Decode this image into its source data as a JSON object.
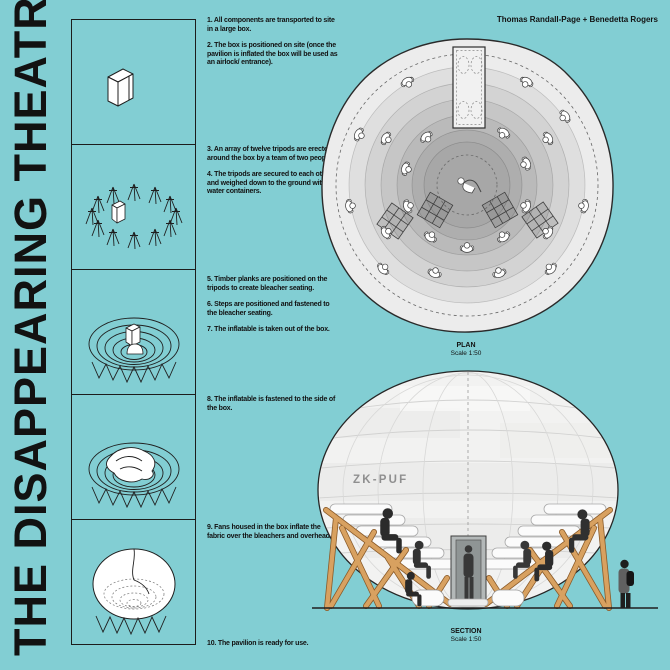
{
  "colors": {
    "background": "#82ced3",
    "ink": "#121212",
    "drawing_line": "#262626",
    "plan_blob": "#ececec",
    "wood": "#d8a160",
    "wood_edge": "#8a5a28",
    "dome_fill": "#f2f2f1",
    "door_grey": "#b3b8b8",
    "figure_dark": "#2e2e2e",
    "dome_text": "#8f8f8f"
  },
  "title": "THE DISAPPEARING THEATRE",
  "credit": "Thomas Randall-Page + Benedetta Rogers",
  "steps": [
    "1. All components are transported to site in a large box.",
    "2. The box is positioned on site (once the pavilion is inflated the box will be used as an airlock/ entrance).",
    "3. An array of twelve tripods are erected around the box by a team of two people.",
    "4. The tripods are secured to each other and weighed down to the ground with water containers.",
    "5. Timber planks are positioned on the tripods to create bleacher seating.",
    "6. Steps are positioned and fastened to the bleacher seating.",
    "7. The inflatable is taken out of the box.",
    "8. The inflatable is fastened to the side of the box.",
    "9. Fans housed in the box inflate the fabric over the bleachers and overhead.",
    "10. The pavilion is ready for use."
  ],
  "plan": {
    "label": "PLAN",
    "scale": "Scale 1:50"
  },
  "section": {
    "label": "SECTION",
    "scale": "Scale 1:50",
    "dome_label": "ZK-PUF"
  },
  "step_panels": [
    {
      "icon": "shipping-box-illustration"
    },
    {
      "icon": "tripod-ring-illustration"
    },
    {
      "icon": "bleacher-ring-box-illustration"
    },
    {
      "icon": "bleacher-ring-inflatable-illustration"
    },
    {
      "icon": "inflated-dome-illustration"
    }
  ]
}
